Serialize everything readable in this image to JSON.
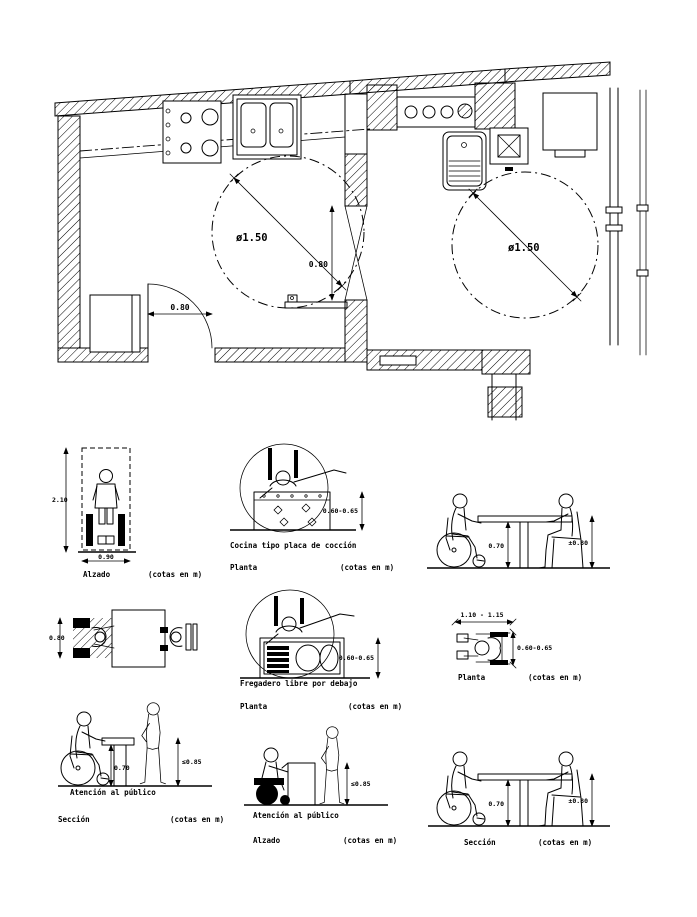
{
  "drawing": {
    "type": "CAD accessibility details — kitchen plan and furniture sections",
    "ink": "#000000",
    "paper": "#ffffff"
  },
  "floor_plan": {
    "turning_circle_left": "ø1.50",
    "turning_circle_right": "ø1.50",
    "door_width": "0.80",
    "partition_door_width": "0.80"
  },
  "figures": {
    "alzado": {
      "label": "Alzado",
      "note": "(cotas en m)",
      "height_dim": "2.10",
      "width_dim": "0.90"
    },
    "cocina": {
      "caption": "Cocina tipo placa de cocción",
      "label": "Planta",
      "note": "(cotas en m)",
      "depth_dim": "0.60-0.65"
    },
    "mesa_sup": {
      "clearance_dim": "0.70",
      "height_dim": "±0.80"
    },
    "mesa_planta": {
      "width_dim": "0.80"
    },
    "fregadero": {
      "caption": "Fregadero libre por debajo",
      "label": "Planta",
      "note": "(cotas en m)",
      "depth_dim": "0.60-0.65"
    },
    "silla_planta": {
      "label": "Planta",
      "note": "(cotas en m)",
      "length_dim": "1.10 - 1.15",
      "width_dim": "0.60-0.65"
    },
    "atencion_sec": {
      "caption": "Atención al público",
      "label": "Sección",
      "note": "(cotas en m)",
      "clearance_dim": "0.70",
      "height_dim": "≤0.85"
    },
    "atencion_alz": {
      "caption": "Atención al público",
      "label": "Alzado",
      "note": "(cotas en m)",
      "height_dim": "≤0.85"
    },
    "mesa_sec": {
      "label": "Sección",
      "note": "(cotas en m)",
      "clearance_dim": "0.70",
      "height_dim": "±0.80"
    }
  }
}
